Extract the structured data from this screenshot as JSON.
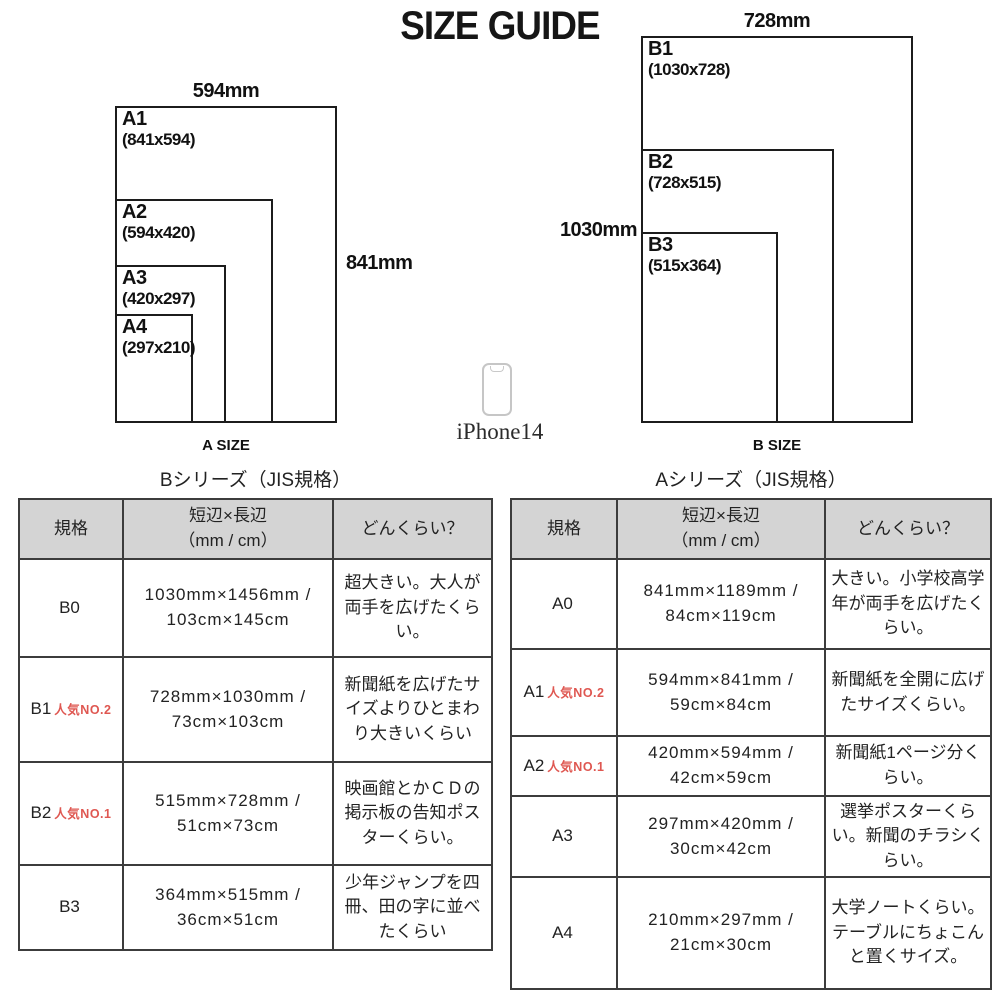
{
  "title": "SIZE GUIDE",
  "colors": {
    "accent_red": "#df5751",
    "header_bg": "#d4d4d4",
    "line": "#1c1c1c"
  },
  "phone": {
    "label": "iPhone14"
  },
  "diagrams": {
    "a": {
      "caption": "A SIZE",
      "top_label": "594mm",
      "side_label": "841mm",
      "sheets": [
        {
          "name": "A1",
          "dims": "(841x594)"
        },
        {
          "name": "A2",
          "dims": "(594x420)"
        },
        {
          "name": "A3",
          "dims": "(420x297)"
        },
        {
          "name": "A4",
          "dims": "(297x210)"
        }
      ]
    },
    "b": {
      "caption": "B SIZE",
      "top_label": "728mm",
      "side_label": "1030mm",
      "sheets": [
        {
          "name": "B1",
          "dims": "(1030x728)"
        },
        {
          "name": "B2",
          "dims": "(728x515)"
        },
        {
          "name": "B3",
          "dims": "(515x364)"
        }
      ]
    }
  },
  "tables": {
    "b": {
      "title": "Bシリーズ（JIS規格）",
      "headers": {
        "spec": "規格",
        "size_line1": "短辺×長辺",
        "size_line2": "（mm / cm）",
        "desc": "どんくらい？"
      },
      "rows": [
        {
          "code": "B0",
          "size": "1030mm×1456mm / 103cm×145cm",
          "desc": "超大きい。大人が両手を広げたくらい。"
        },
        {
          "code": "B1",
          "badge": "人気NO.2",
          "size": "728mm×1030mm / 73cm×103cm",
          "desc": "新聞紙を広げたサイズよりひとまわり大きいくらい"
        },
        {
          "code": "B2",
          "badge": "人気NO.1",
          "size": "515mm×728mm / 51cm×73cm",
          "desc": "映画館とかＣＤの掲示板の告知ポスターくらい。"
        },
        {
          "code": "B3",
          "size": "364mm×515mm / 36cm×51cm",
          "desc": "少年ジャンプを四冊、田の字に並べたくらい"
        }
      ]
    },
    "a": {
      "title": "Aシリーズ（JIS規格）",
      "headers": {
        "spec": "規格",
        "size_line1": "短辺×長辺",
        "size_line2": "（mm / cm）",
        "desc": "どんくらい？"
      },
      "rows": [
        {
          "code": "A0",
          "size": "841mm×1189mm / 84cm×119cm",
          "desc": "大きい。小学校高学年が両手を広げたくらい。"
        },
        {
          "code": "A1",
          "badge": "人気NO.2",
          "size": "594mm×841mm / 59cm×84cm",
          "desc": "新聞紙を全開に広げたサイズくらい。"
        },
        {
          "code": "A2",
          "badge": "人気NO.1",
          "size": "420mm×594mm / 42cm×59cm",
          "desc": "新聞紙1ページ分くらい。"
        },
        {
          "code": "A3",
          "size": "297mm×420mm / 30cm×42cm",
          "desc": "選挙ポスターくらい。新聞のチラシくらい。"
        },
        {
          "code": "A4",
          "size": "210mm×297mm / 21cm×30cm",
          "desc": "大学ノートくらい。テーブルにちょこんと置くサイズ。"
        }
      ]
    }
  }
}
